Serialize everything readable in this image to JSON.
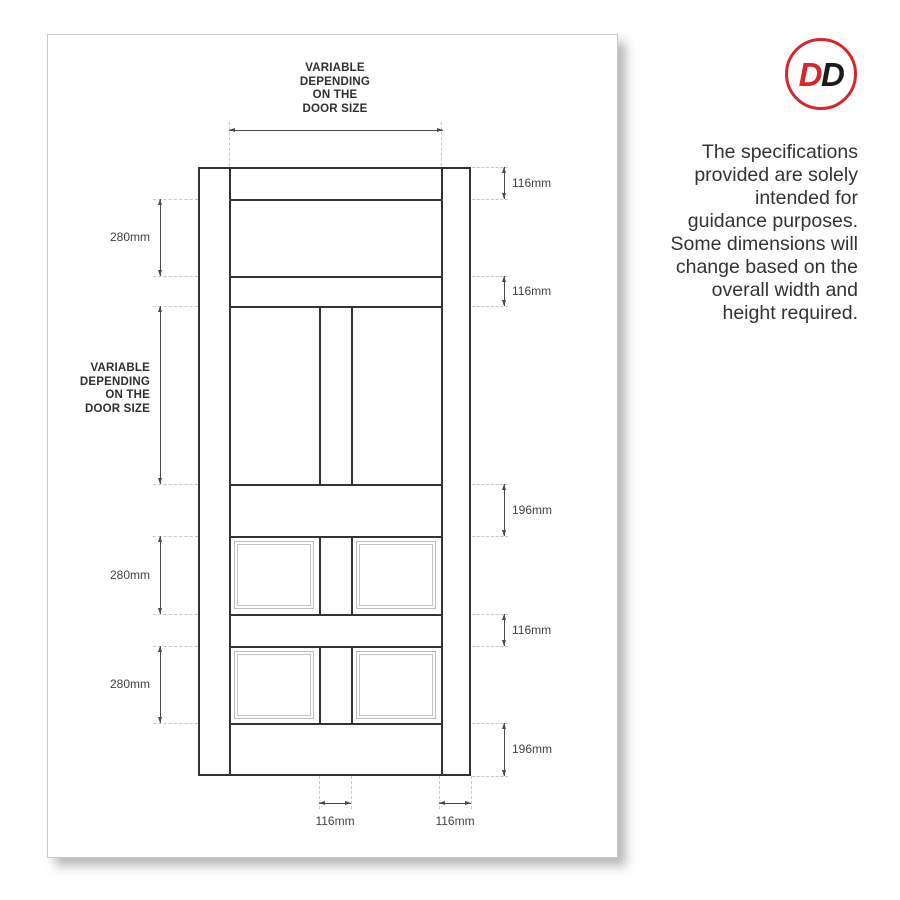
{
  "logo": {
    "d1": "D",
    "d2": "D"
  },
  "note": "The specifications\nprovided are solely\nintended for\nguidance purposes.\nSome dimensions will\nchange based on the\noverall width and\nheight required.",
  "diagram": {
    "top_width_label": "VARIABLE\nDEPENDING\nON THE\nDOOR SIZE",
    "left_height_label": "VARIABLE\nDEPENDING\nON THE\nDOOR SIZE",
    "right_dims": [
      "116mm",
      "116mm",
      "196mm",
      "116mm",
      "196mm"
    ],
    "left_dims": [
      "280mm",
      "280mm",
      "280mm"
    ],
    "bottom_dims": [
      "116mm",
      "116mm"
    ]
  },
  "colors": {
    "accent_red": "#d8262d",
    "door_line": "#333333",
    "extension_dash": "#c8c8c8",
    "text": "#333333"
  }
}
